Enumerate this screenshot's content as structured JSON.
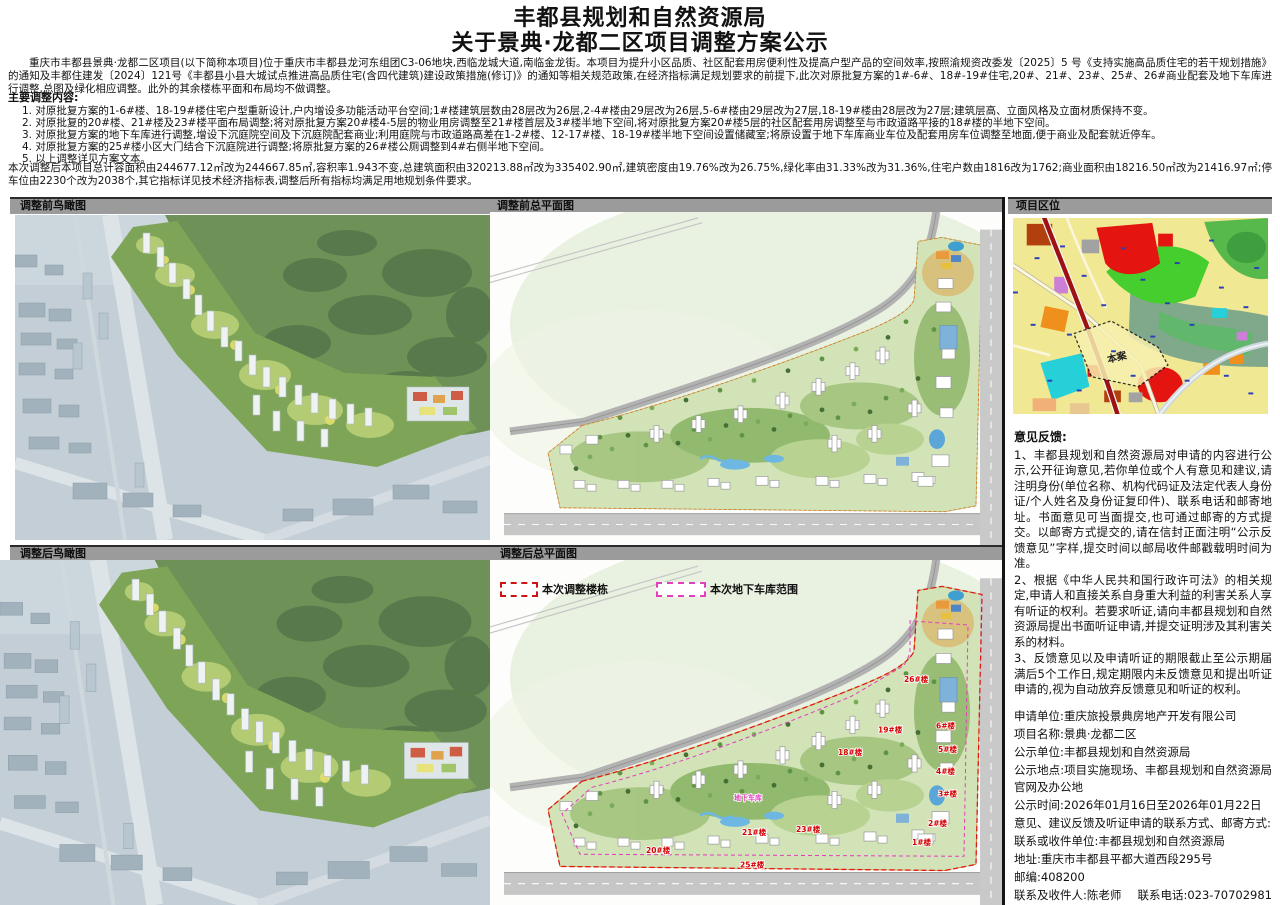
{
  "header": {
    "title_line1": "丰都县规划和自然资源局",
    "title_line2": "关于景典·龙都二区项目调整方案公示"
  },
  "intro": "重庆市丰都县景典·龙都二区项目(以下简称本项目)位于重庆市丰都县龙河东组团C3-06地块,西临龙城大道,南临金龙街。本项目为提升小区品质、社区配套用房便利性及提高户型产品的空间效率,按照渝规资改委发〔2025〕5 号《支持实施高品质住宅的若干规划措施》的通知及丰都住建发〔2024〕121号《丰都县小县大城试点推进高品质住宅(含四代建筑)建设政策措施(修订)》的通知等相关规范政策,在经济指标满足规划要求的前提下,此次对原批复方案的1#-6#、18#-19#住宅,20#、21#、23#、25#、26#商业配套及地下车库进行调整,总图及绿化相应调整。此外的其余楼栋平面和布局均不做调整。",
  "adjustments": {
    "heading": "主要调整内容:",
    "items": [
      "1. 对原批复方案的1-6#楼、18-19#楼住宅户型重新设计,户内增设多功能活动平台空间;1#楼建筑层数由28层改为26层,2-4#楼由29层改为26层,5-6#楼由29层改为27层,18-19#楼由28层改为27层;建筑层高、立面风格及立面材质保持不变。",
      "2. 对原批复的20#楼、21#楼及23#楼平面布局调整;将对原批复方案20#楼4-5层的物业用房调整至21#楼首层及3#楼半地下空间,将对原批复方案20#楼5层的社区配套用房调整至与市政道路平接的18#楼的半地下空间。",
      "3. 对原批复方案的地下车库进行调整,增设下沉庭院空间及下沉庭院配套商业;利用庭院与市政道路高差在1-2#楼、12-17#楼、18-19#楼半地下空间设置储藏室;将原设置于地下车库商业车位及配套用房车位调整至地面,便于商业及配套就近停车。",
      "4. 对原批复方案的25#楼小区大门结合下沉庭院进行调整;将原批复方案的26#楼公厕调整到4#右侧半地下空间。",
      "5. 以上调整详见方案文本。"
    ]
  },
  "summary": "本次调整后本项目总计容面积由244677.12㎡改为244667.85㎡,容积率1.943不变,总建筑面积由320213.88㎡改为335402.90㎡,建筑密度由19.76%改为26.75%,绿化率由31.33%改为31.36%,住宅户数由1816改为1762;商业面积由18216.50㎡改为21416.97㎡;停车位由2230个改为2038个,其它指标详见技术经济指标表,调整后所有指标均满足用地规划条件要求。",
  "sections": {
    "aerial_before": "调整前鸟瞰图",
    "plan_before": "调整前总平面图",
    "location": "项目区位",
    "aerial_after": "调整后鸟瞰图",
    "plan_after": "调整后总平面图"
  },
  "legend": {
    "adjusted_label": "本次调整楼栋",
    "garage_label": "本次地下车库范围",
    "adjusted_color": "#cc1414",
    "garage_color": "#e23fbe"
  },
  "location_map": {
    "site_label": "本案"
  },
  "plan_after_labels": [
    {
      "text": "26#楼"
    },
    {
      "text": "19#楼"
    },
    {
      "text": "18#楼"
    },
    {
      "text": "6#楼"
    },
    {
      "text": "5#楼"
    },
    {
      "text": "4#楼"
    },
    {
      "text": "3#楼"
    },
    {
      "text": "2#楼"
    },
    {
      "text": "1#楼"
    },
    {
      "text": "23#楼"
    },
    {
      "text": "21#楼"
    },
    {
      "text": "20#楼"
    },
    {
      "text": "25#楼"
    },
    {
      "text": "地下车库"
    }
  ],
  "feedback": {
    "heading": "意见反馈:",
    "paragraphs": [
      "1、丰都县规划和自然资源局对申请的内容进行公示,公开征询意见,若你单位或个人有意见和建议,请注明身份(单位名称、机构代码证及法定代表人身份证/个人姓名及身份证复印件)、联系电话和邮寄地址。书面意见可当面提交,也可通过邮寄的方式提交。以邮寄方式提交的,请在信封正面注明“公示反馈意见”字样,提交时间以邮局收件邮戳载明时间为准。",
      "2、根据《中华人民共和国行政许可法》的相关规定,申请人和直接关系自身重大利益的利害关系人享有听证的权利。若要求听证,请向丰都县规划和自然资源局提出书面听证申请,并提交证明涉及其利害关系的材料。",
      "3、反馈意见以及申请听证的期限截止至公示期届满后5个工作日,规定期限内未反馈意见和提出听证申请的,视为自动放弃反馈意见和听证的权利。"
    ],
    "info_lines": [
      "申请单位:重庆旅投景典房地产开发有限公司",
      "项目名称:景典·龙都二区",
      "公示单位:丰都县规划和自然资源局",
      "公示地点:项目实施现场、丰都县规划和自然资源局官网及办公地",
      "公示时间:2026年01月16日至2026年01月22日",
      "意见、建议反馈及听证申请的联系方式、邮寄方式:",
      "联系或收件单位:丰都县规划和自然资源局",
      "地址:重庆市丰都县平都大道西段295号",
      "邮编:408200"
    ],
    "contact_name": "联系及收件人:陈老师",
    "contact_phone": "联系电话:023-70702981",
    "note": "【注:如当面提交,可交至丰都县规划和自然资源局第9楼工程规划管理科办公室(0912)】"
  }
}
